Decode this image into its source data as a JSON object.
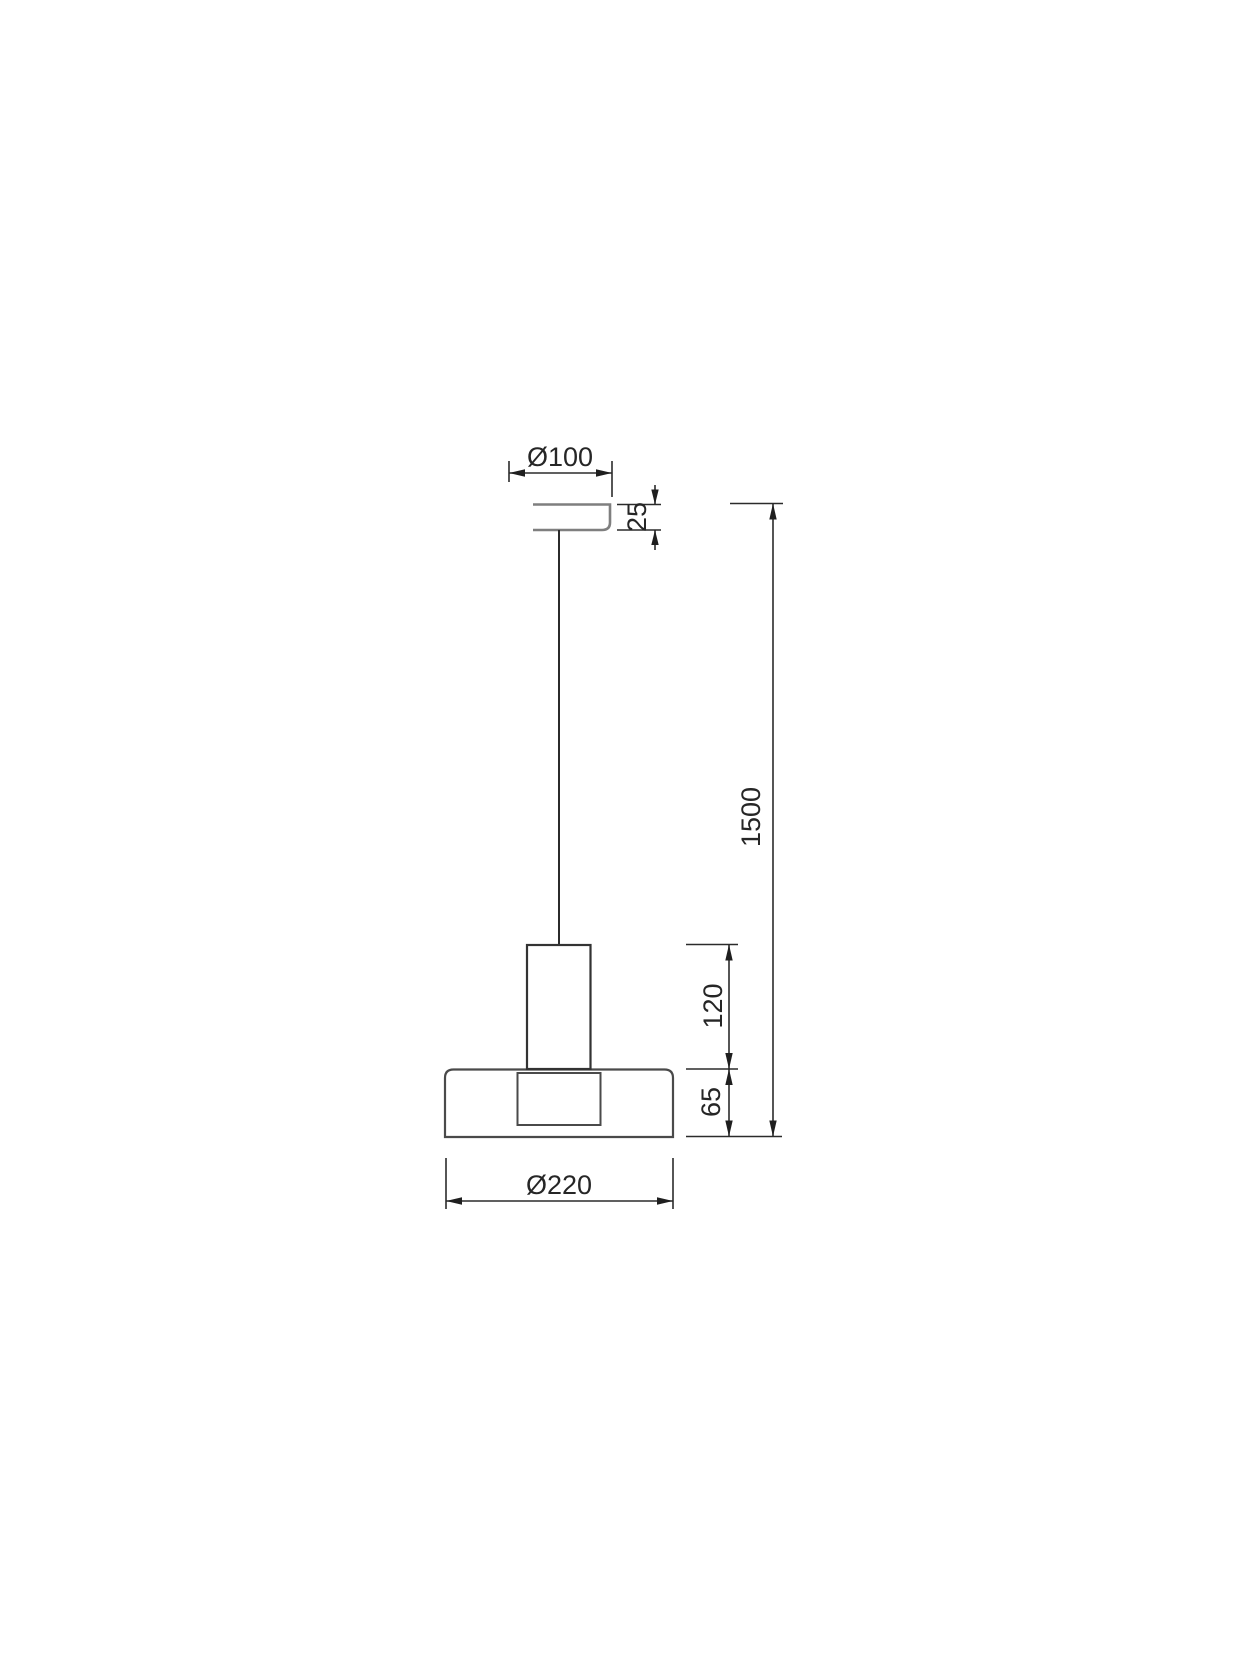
{
  "drawing": {
    "kind": "pendant-lamp-dimension-drawing",
    "dim_labels": {
      "canopy_diameter": "Ø100",
      "canopy_height": "25",
      "suspension_length": "1500",
      "socket_height": "120",
      "shade_height": "65",
      "shade_diameter": "Ø220"
    },
    "colors": {
      "background": "#ffffff",
      "canopy_outline": "#7f7f7f",
      "product_outline": "#3d3d3d",
      "socket_outline": "#333333",
      "cord": "#2b2b2b",
      "dimension_lines": "#2b2b2b",
      "arrows": "#1f1f1f",
      "text": "#262626"
    }
  }
}
